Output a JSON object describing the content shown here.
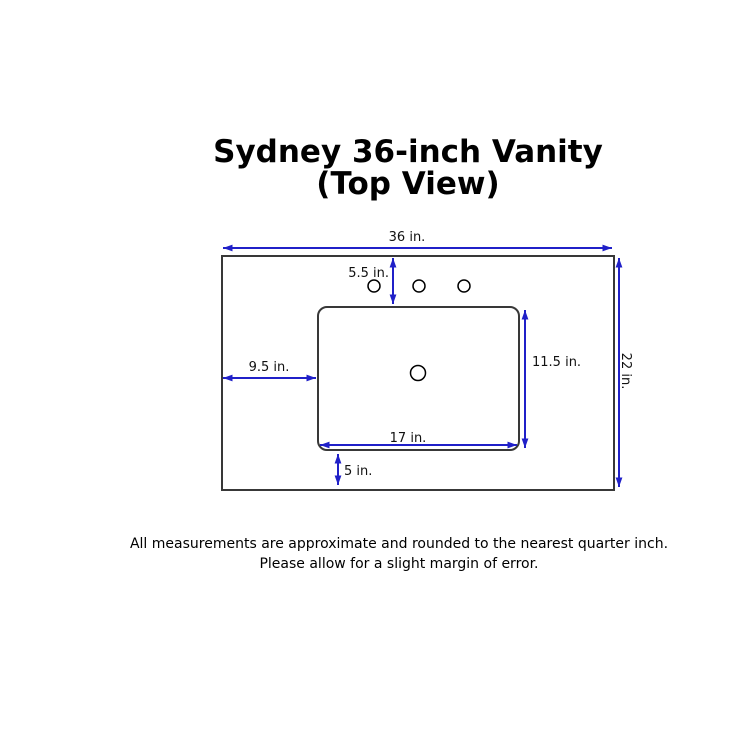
{
  "title": {
    "line1": "Sydney 36-inch Vanity",
    "line2": "(Top View)"
  },
  "diagram": {
    "labels": {
      "overall_width": "36 in.",
      "overall_depth": "22 in.",
      "faucet_offset": "5.5 in.",
      "sink_left_offset": "9.5 in.",
      "sink_depth": "11.5 in.",
      "sink_width": "17 in.",
      "sink_bottom_offset": "5 in."
    },
    "colors": {
      "dimension_arrow": "#2020c8",
      "countertop_outline": "#383838",
      "hole_outline": "#000000",
      "background": "#ffffff"
    }
  },
  "footer": {
    "line1": "All measurements are approximate and rounded to the nearest quarter inch.",
    "line2": "Please allow for a slight margin of error."
  }
}
